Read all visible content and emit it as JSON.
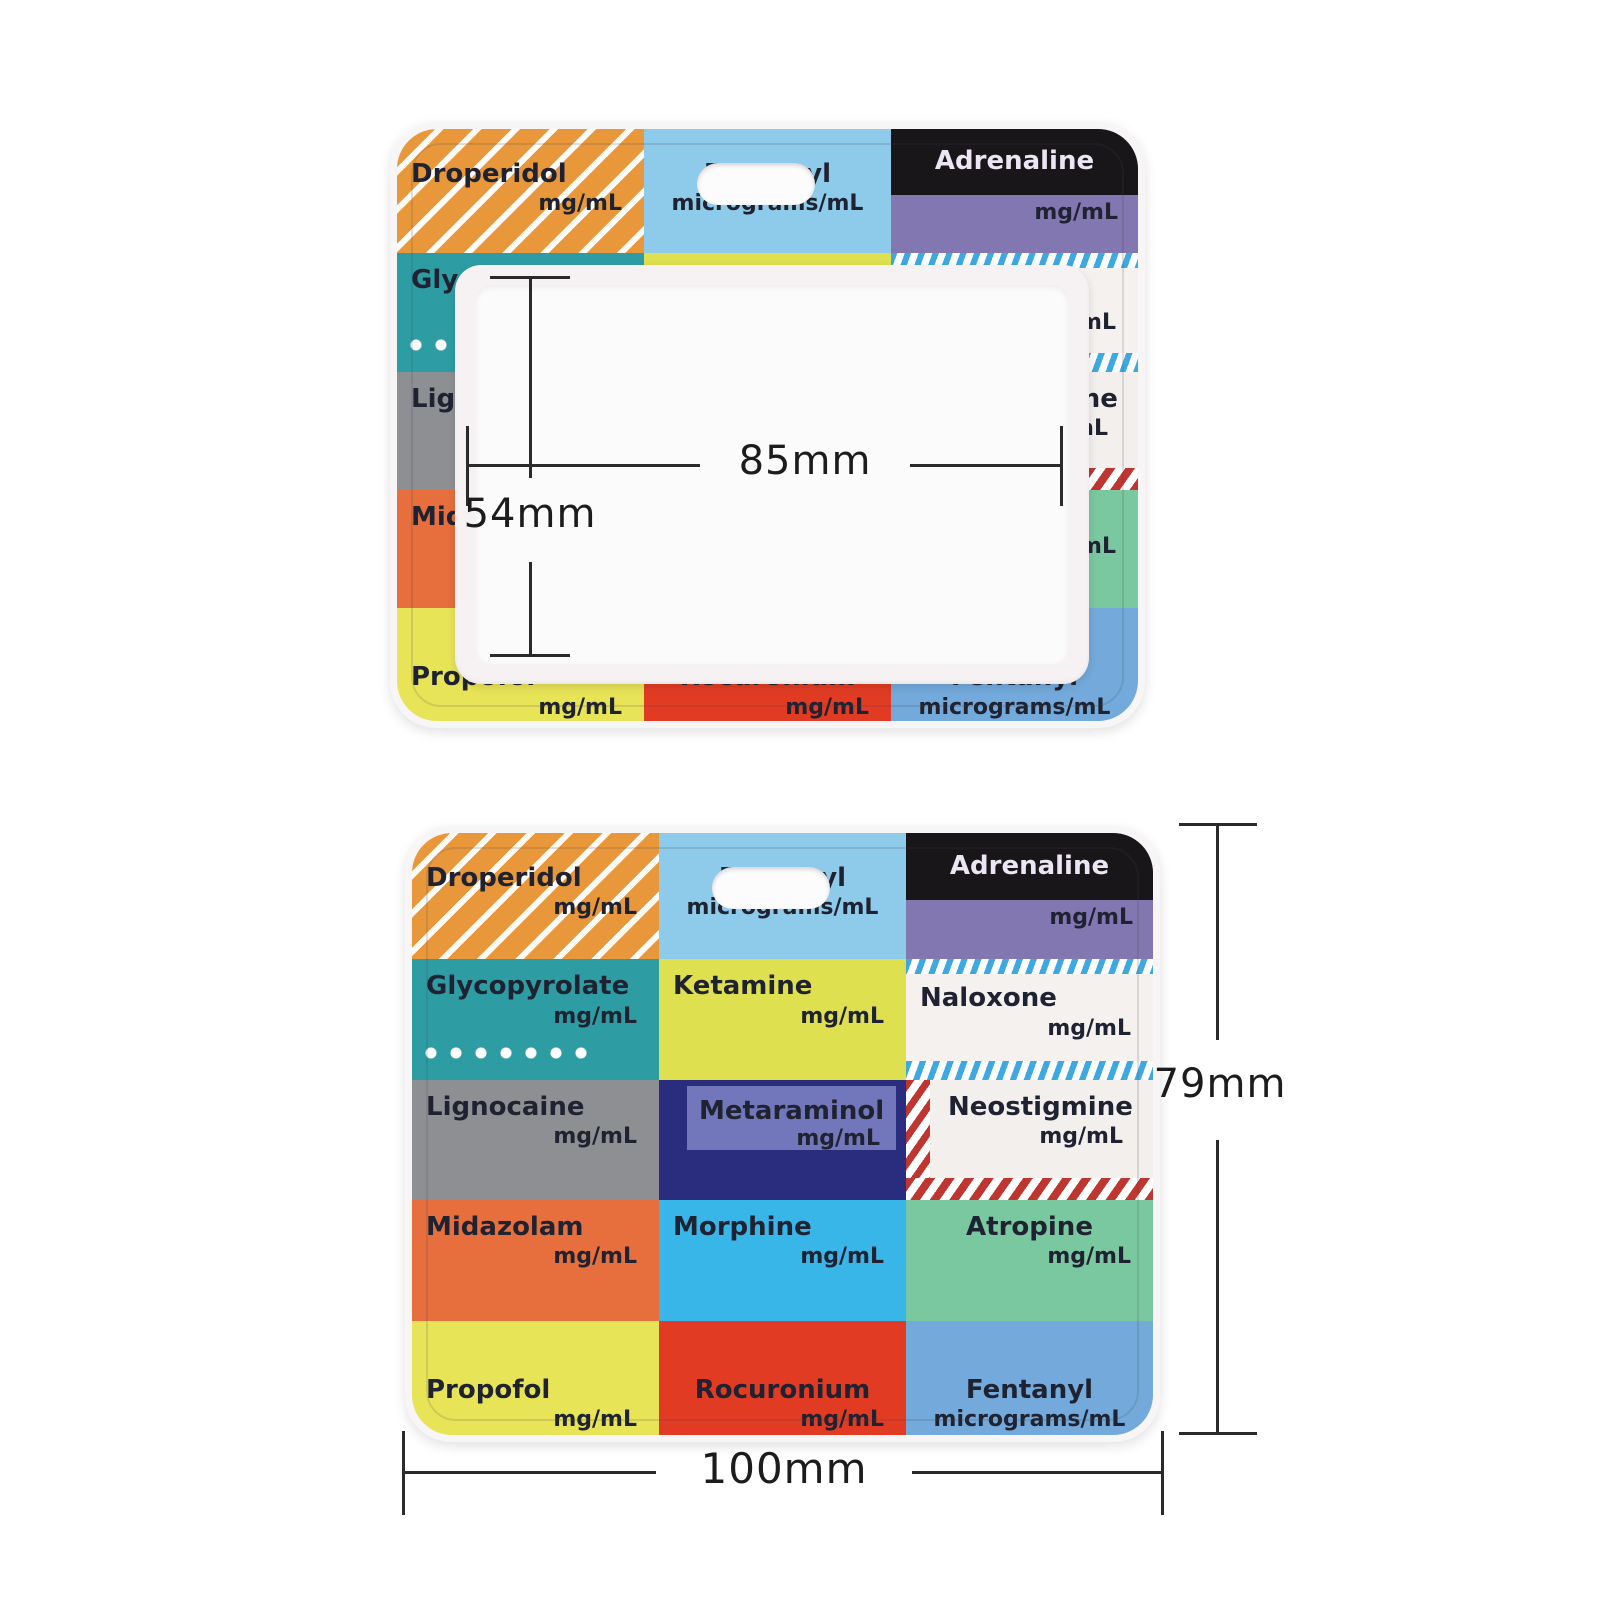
{
  "product": {
    "description_top_view": "badge holder with clear card window",
    "description_bottom_view": "printed drug-label card"
  },
  "dimensions": {
    "window_width": "85mm",
    "window_height": "54mm",
    "card_height": "79mm",
    "card_width": "100mm"
  },
  "colors": {
    "holder_rim": "#f8f5f7",
    "frame": "#f6f2f4",
    "window": "#fcfbfc",
    "dimension_line": "#2a2a2a",
    "drug_text": "#1f2230"
  },
  "drug_grid": {
    "columns": 3,
    "rows": 5,
    "cells": [
      {
        "name": "Droperidol",
        "unit": "mg/mL",
        "variant": "droperidol",
        "bg": "#e8983a"
      },
      {
        "name": "Fentanyl",
        "unit": "micrograms/mL",
        "variant": "fentanyl-top",
        "bg": "#8ecaea",
        "align": "center",
        "unit_align": "center"
      },
      {
        "name": "Adrenaline",
        "unit": "mg/mL",
        "variant": "adrenaline",
        "bg": "#8377b2",
        "band": "#19161a",
        "name_color": "#ece5f3"
      },
      {
        "name": "Glycopyrolate",
        "unit": "mg/mL",
        "variant": "glycopyrolate",
        "bg": "#2d9da3",
        "dots": true
      },
      {
        "name": "Ketamine",
        "unit": "mg/mL",
        "variant": "ketamine",
        "bg": "#dee04f"
      },
      {
        "name": "Naloxone",
        "unit": "mg/mL",
        "variant": "naloxone",
        "bg": "#f4f1ef",
        "stripe": "#3ea8e0"
      },
      {
        "name": "Lignocaine",
        "unit": "mg/mL",
        "variant": "lignocaine",
        "bg": "#8e8f93"
      },
      {
        "name": "Metaraminol",
        "unit": "mg/mL",
        "variant": "metaraminol",
        "bg": "#2a2c7d",
        "panel": "#7276ba"
      },
      {
        "name": "Neostigmine",
        "unit": "mg/mL",
        "variant": "neostigmine",
        "bg": "#f2efed",
        "stripe": "#bf3530"
      },
      {
        "name": "Midazolam",
        "unit": "mg/mL",
        "variant": "midazolam",
        "bg": "#e66f3d"
      },
      {
        "name": "Morphine",
        "unit": "mg/mL",
        "variant": "morphine",
        "bg": "#38b6e8"
      },
      {
        "name": "Atropine",
        "unit": "mg/mL",
        "variant": "atropine",
        "bg": "#7ac8a0",
        "align": "center"
      },
      {
        "name": "Propofol",
        "unit": "mg/mL",
        "variant": "propofol",
        "bg": "#e8e458"
      },
      {
        "name": "Rocuronium",
        "unit": "mg/mL",
        "variant": "rocuronium",
        "bg": "#e13b23",
        "align": "center"
      },
      {
        "name": "Fentanyl",
        "unit": "micrograms/mL",
        "variant": "fentanyl-bottom",
        "bg": "#73aadb",
        "align": "center",
        "unit_align": "center"
      }
    ]
  }
}
